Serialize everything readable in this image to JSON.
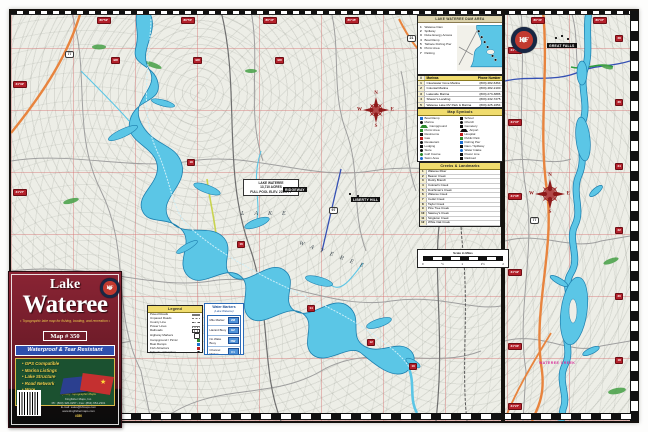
{
  "compass": {
    "n": "N",
    "e": "E",
    "s": "S",
    "w": "W"
  },
  "logo": {
    "monogram": "KF"
  },
  "map_labels": {
    "lake_word": "LAKE",
    "wateree_word": "WATEREE",
    "info_box_lines": [
      "LAKE WATEREE",
      "13,710 ACRES",
      "FULL POOL ELEV. 225.5 FT"
    ],
    "magenta_label": "WATEREE CREEK",
    "town_pills": [
      {
        "text": "GREAT FALLS",
        "x": 536,
        "y": 32
      },
      {
        "text": "RIDGEWAY",
        "x": 272,
        "y": 176
      },
      {
        "text": "LIBERTY HILL",
        "x": 340,
        "y": 186
      }
    ],
    "shields": [
      {
        "text": "77",
        "x": 54,
        "y": 40
      },
      {
        "text": "21",
        "x": 396,
        "y": 24
      },
      {
        "text": "97",
        "x": 318,
        "y": 196
      },
      {
        "text": "77",
        "x": 519,
        "y": 206
      }
    ]
  },
  "red_markers": [
    {
      "text": "80°52'",
      "x": 86,
      "y": 6
    },
    {
      "text": "80°50'",
      "x": 170,
      "y": 6
    },
    {
      "text": "80°47'",
      "x": 252,
      "y": 6
    },
    {
      "text": "80°45'",
      "x": 334,
      "y": 6
    },
    {
      "text": "80°42'",
      "x": 418,
      "y": 6
    },
    {
      "text": "34°32'",
      "x": 2,
      "y": 70
    },
    {
      "text": "34°27'",
      "x": 2,
      "y": 178
    },
    {
      "text": "34°22'",
      "x": 2,
      "y": 344
    },
    {
      "text": "BR",
      "x": 100,
      "y": 46
    },
    {
      "text": "BR",
      "x": 182,
      "y": 46
    },
    {
      "text": "BR",
      "x": 264,
      "y": 46
    },
    {
      "text": "18",
      "x": 176,
      "y": 148
    },
    {
      "text": "16",
      "x": 226,
      "y": 230
    },
    {
      "text": "14",
      "x": 296,
      "y": 294
    },
    {
      "text": "12",
      "x": 356,
      "y": 328
    },
    {
      "text": "10",
      "x": 398,
      "y": 352
    },
    {
      "text": "34°40'",
      "x": 497,
      "y": 36
    },
    {
      "text": "34°37'",
      "x": 497,
      "y": 108
    },
    {
      "text": "34°35'",
      "x": 497,
      "y": 182
    },
    {
      "text": "34°32'",
      "x": 497,
      "y": 258
    },
    {
      "text": "34°30'",
      "x": 497,
      "y": 332
    },
    {
      "text": "34°27'",
      "x": 497,
      "y": 392
    },
    {
      "text": "28",
      "x": 604,
      "y": 24
    },
    {
      "text": "26",
      "x": 604,
      "y": 88
    },
    {
      "text": "24",
      "x": 604,
      "y": 152
    },
    {
      "text": "22",
      "x": 604,
      "y": 216
    },
    {
      "text": "20",
      "x": 604,
      "y": 282
    },
    {
      "text": "18",
      "x": 604,
      "y": 346
    },
    {
      "text": "80°40'",
      "x": 520,
      "y": 6
    },
    {
      "text": "80°37'",
      "x": 582,
      "y": 6
    }
  ],
  "inset": {
    "title": "LAKE WATEREE DAM AREA",
    "items": [
      {
        "n": "1",
        "label": "Wateree Dam"
      },
      {
        "n": "2",
        "label": "Spillway"
      },
      {
        "n": "3",
        "label": "Duke Energy Access"
      },
      {
        "n": "4",
        "label": "Boat Ramp"
      },
      {
        "n": "5",
        "label": "Tailrace Fishing Pier"
      },
      {
        "n": "6",
        "label": "Picnic Area"
      },
      {
        "n": "7",
        "label": "Parking"
      }
    ]
  },
  "marinas": {
    "col_num": "#",
    "col_name": "Marinas",
    "col_phone": "Phone Number",
    "rows": [
      {
        "n": "1",
        "name": "Clearwater Cove Marina",
        "phone": "(803) 482-6364"
      },
      {
        "n": "2",
        "name": "Colonial Marina",
        "phone": "(803) 482-2100"
      },
      {
        "n": "3",
        "name": "Lakeside Marina",
        "phone": "(803) 273-3886"
      },
      {
        "n": "4",
        "name": "Shaver's Landing",
        "phone": "(803) 432-7275"
      },
      {
        "n": "5",
        "name": "Wateree Lake RV Park & Marina",
        "phone": "(803) 425-1654"
      }
    ]
  },
  "symbols": {
    "title": "Map Symbols",
    "left": [
      {
        "glyph": "g-sq-b",
        "label": "Boat Ramp"
      },
      {
        "glyph": "g-dot-k",
        "label": "Marina"
      },
      {
        "glyph": "g-tri-g",
        "label": "Campground"
      },
      {
        "glyph": "g-sq-g",
        "label": "Picnic Area"
      },
      {
        "glyph": "g-sq-k",
        "label": "Restrooms"
      },
      {
        "glyph": "g-sq-r",
        "label": "Gas"
      },
      {
        "glyph": "g-dot-k",
        "label": "Restaurant"
      },
      {
        "glyph": "g-sq-k",
        "label": "Lodging"
      },
      {
        "glyph": "g-dot-k",
        "label": "Store"
      },
      {
        "glyph": "g-dot-g",
        "label": "Golf Course"
      },
      {
        "glyph": "g-dot-b",
        "label": "Swim Area"
      }
    ],
    "right": [
      {
        "glyph": "g-sq-k",
        "label": "School"
      },
      {
        "glyph": "g-dot-k",
        "label": "Church"
      },
      {
        "glyph": "g-sq-k",
        "label": "Cemetery"
      },
      {
        "glyph": "g-tri-k",
        "label": "Airport"
      },
      {
        "glyph": "g-sq-r",
        "label": "Hospital"
      },
      {
        "glyph": "g-sq-g",
        "label": "Public Park"
      },
      {
        "glyph": "g-sq-b",
        "label": "Fishing Pier"
      },
      {
        "glyph": "g-sq-k",
        "label": "Dam / Spillway"
      },
      {
        "glyph": "g-dot-b",
        "label": "Water Intake"
      },
      {
        "glyph": "g-sq-k",
        "label": "Power Line"
      },
      {
        "glyph": "g-sq-k",
        "label": "Railroad"
      }
    ]
  },
  "creeks": {
    "title": "Creeks & Landmarks",
    "rows": [
      {
        "n": "1",
        "name": "Wateree River"
      },
      {
        "n": "2",
        "name": "Beaver Creek"
      },
      {
        "n": "3",
        "name": "Rocky Branch"
      },
      {
        "n": "4",
        "name": "Colonel's Creek"
      },
      {
        "n": "5",
        "name": "Dutchman's Creek"
      },
      {
        "n": "6",
        "name": "Wateree Creek"
      },
      {
        "n": "7",
        "name": "Cedar Creek"
      },
      {
        "n": "8",
        "name": "Taylor Creek"
      },
      {
        "n": "9",
        "name": "Pine Tree Creek"
      },
      {
        "n": "10",
        "name": "Sawney's Creek"
      },
      {
        "n": "11",
        "name": "Singleton Creek"
      },
      {
        "n": "12",
        "name": "White Oak Creek"
      },
      {
        "n": "13",
        "name": "June Branch"
      },
      {
        "n": "14",
        "name": "Lake Wateree State Park"
      },
      {
        "n": "15",
        "name": "Wateree Dam"
      }
    ]
  },
  "scalebar": {
    "label": "Scale in Miles",
    "ticks": [
      "0",
      "½",
      "1",
      "1½",
      "2"
    ]
  },
  "legend": {
    "title": "Legend",
    "rows": [
      {
        "glyph": "l-road",
        "label": "Paved Roads"
      },
      {
        "glyph": "l-dash",
        "label": "Unpaved Roads"
      },
      {
        "glyph": "l-dashdot",
        "label": "County Line"
      },
      {
        "glyph": "l-tick",
        "label": "Power Lines"
      },
      {
        "glyph": "l-rail",
        "label": "Railroads"
      },
      {
        "glyph": "l-shield",
        "label": "Highway Markers"
      },
      {
        "glyph": "g-sq-g",
        "label": "Campground / Picnic"
      },
      {
        "glyph": "g-sq-b",
        "label": "Boat Ramps"
      },
      {
        "glyph": "g-sq-r",
        "label": "Fish Attractors"
      },
      {
        "glyph": "g-dot-k",
        "label": "Schools / Churches"
      }
    ]
  },
  "water_markers": {
    "title": "Water Markers",
    "subtitle": "(Lake Wateree)",
    "rows": [
      {
        "label": "Mile Marker",
        "value": "2M"
      },
      {
        "label": "Hazard Buoy",
        "value": "HZ"
      },
      {
        "label": "No Wake Buoy",
        "value": "NW"
      },
      {
        "label": "Channel Marker",
        "value": "C1"
      }
    ]
  },
  "title_block": {
    "series": "Lake",
    "name": "Wateree",
    "tagline": "• Topographic lake map for fishing, boating, and recreation •",
    "map_number": "Map # 350",
    "banner": "Waterproof & Tear Resistant",
    "features": [
      "• GPS Compatible",
      "• Marina Listings",
      "• Lake Structure",
      "• Road Network",
      "• More"
    ],
    "slogan": "Quality Topographic Maps",
    "contact_lines": [
      "Kingfisher Maps, Inc.",
      "Ph: (800) 326-0257 • Fax: (864) 654-2301",
      "E-mail: sales@kfmaps.com",
      "www.kingfishermaps.com"
    ],
    "item_line": "#350"
  },
  "colors": {
    "water": "#5bc6e6",
    "water_edge": "#1d7fae",
    "road_orange": "#e8843e",
    "marker_red": "#b3202a",
    "cover_maroon": "#6c1b28",
    "banner_blue": "#2e4fae",
    "panel_green": "#1b5130",
    "gold": "#e9c94d"
  }
}
